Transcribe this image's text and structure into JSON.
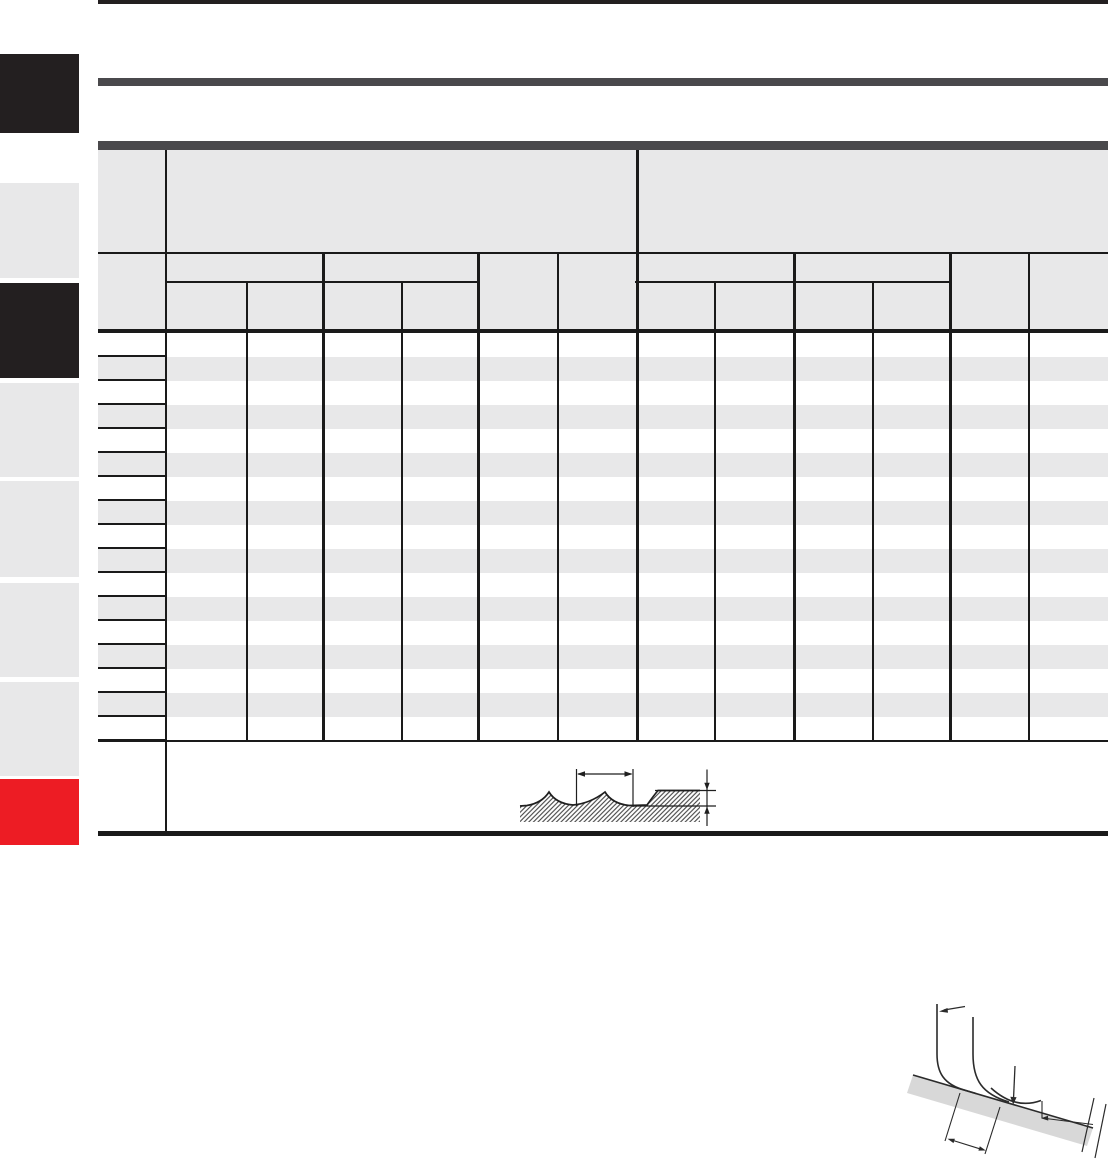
{
  "page": {
    "kind": "technical-catalog-page",
    "width": 1108,
    "height": 1159,
    "background": "#ffffff",
    "visible_text": []
  },
  "colors": {
    "near_black": "#231f20",
    "dark_bar_gray": "#4a494c",
    "light_gray_fill": "#e8e8e9",
    "tab_red": "#ed1c24",
    "table_line": "#1a1a1a",
    "diagram_band_gray": "#d8d8d8",
    "diagram_stroke": "#2b2b2b",
    "white": "#ffffff"
  },
  "sidebar": {
    "tabs": [
      {
        "id": "tab-1",
        "style": "black"
      },
      {
        "id": "tab-2",
        "style": "gray"
      },
      {
        "id": "tab-3",
        "style": "black"
      },
      {
        "id": "tab-4",
        "style": "gray"
      },
      {
        "id": "tab-5",
        "style": "gray"
      },
      {
        "id": "tab-6",
        "style": "gray"
      },
      {
        "id": "tab-7",
        "style": "gray"
      },
      {
        "id": "tab-8",
        "style": "red"
      }
    ]
  },
  "table": {
    "header": {
      "header_rows": 3,
      "left_column_cells": [
        "",
        ""
      ],
      "group_cells": [
        "",
        ""
      ],
      "subgroup_cells": [
        "",
        "",
        "",
        "",
        "",
        "",
        "",
        ""
      ],
      "leaf_columns": 12,
      "all_labels_empty": true
    },
    "body": {
      "data_rows": 17,
      "columns": 12,
      "zebra_striping": true,
      "cells_empty": true
    },
    "footer": {
      "content": "surface-roughness-diagram"
    }
  },
  "diagrams": {
    "surface_roughness_profile": {
      "elements": [
        "hatched-surface-with-two-cusps-and-flat-plateau",
        "pitch-dimension-double-arrow",
        "height-dimension-arrows"
      ]
    },
    "insert_corner_geometry": {
      "elements": [
        "two-nose-radius-curves",
        "wiper-flat-arc",
        "inclined-surface-band",
        "down-arrow",
        "pointer-arrow",
        "feed-dimension-double-arrow",
        "angle-reference-line",
        "break-tick-marks"
      ]
    }
  }
}
